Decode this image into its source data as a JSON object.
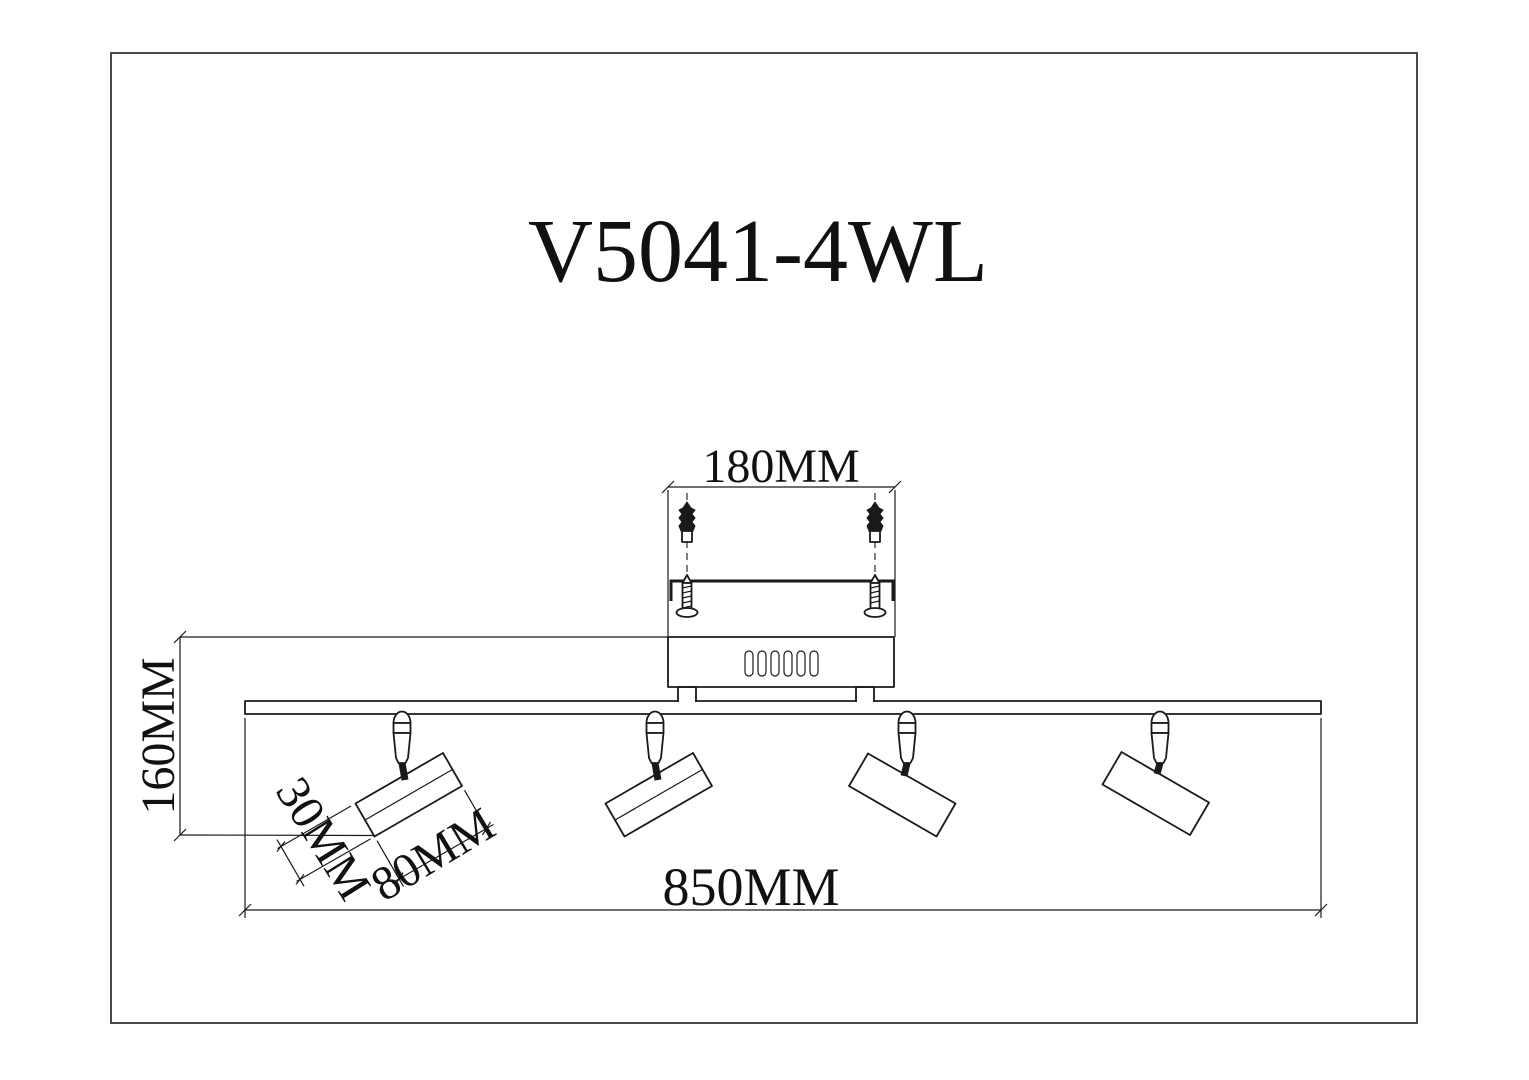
{
  "drawing": {
    "title": "V5041-4WL",
    "kind": "spotlight-fixture-dimension-drawing"
  },
  "dimensions": {
    "mounting_plate_width": "180MM",
    "fixture_height": "160MM",
    "head_diameter": "30MM",
    "head_length": "80MM",
    "bar_length": "850MM"
  },
  "counts": {
    "spotlights": 4,
    "vent_slots": 6,
    "wall_anchors": 2,
    "screws": 2
  },
  "colors": {
    "line": "#1a1a1a",
    "frame": "#4a4a4a",
    "background": "#ffffff"
  }
}
